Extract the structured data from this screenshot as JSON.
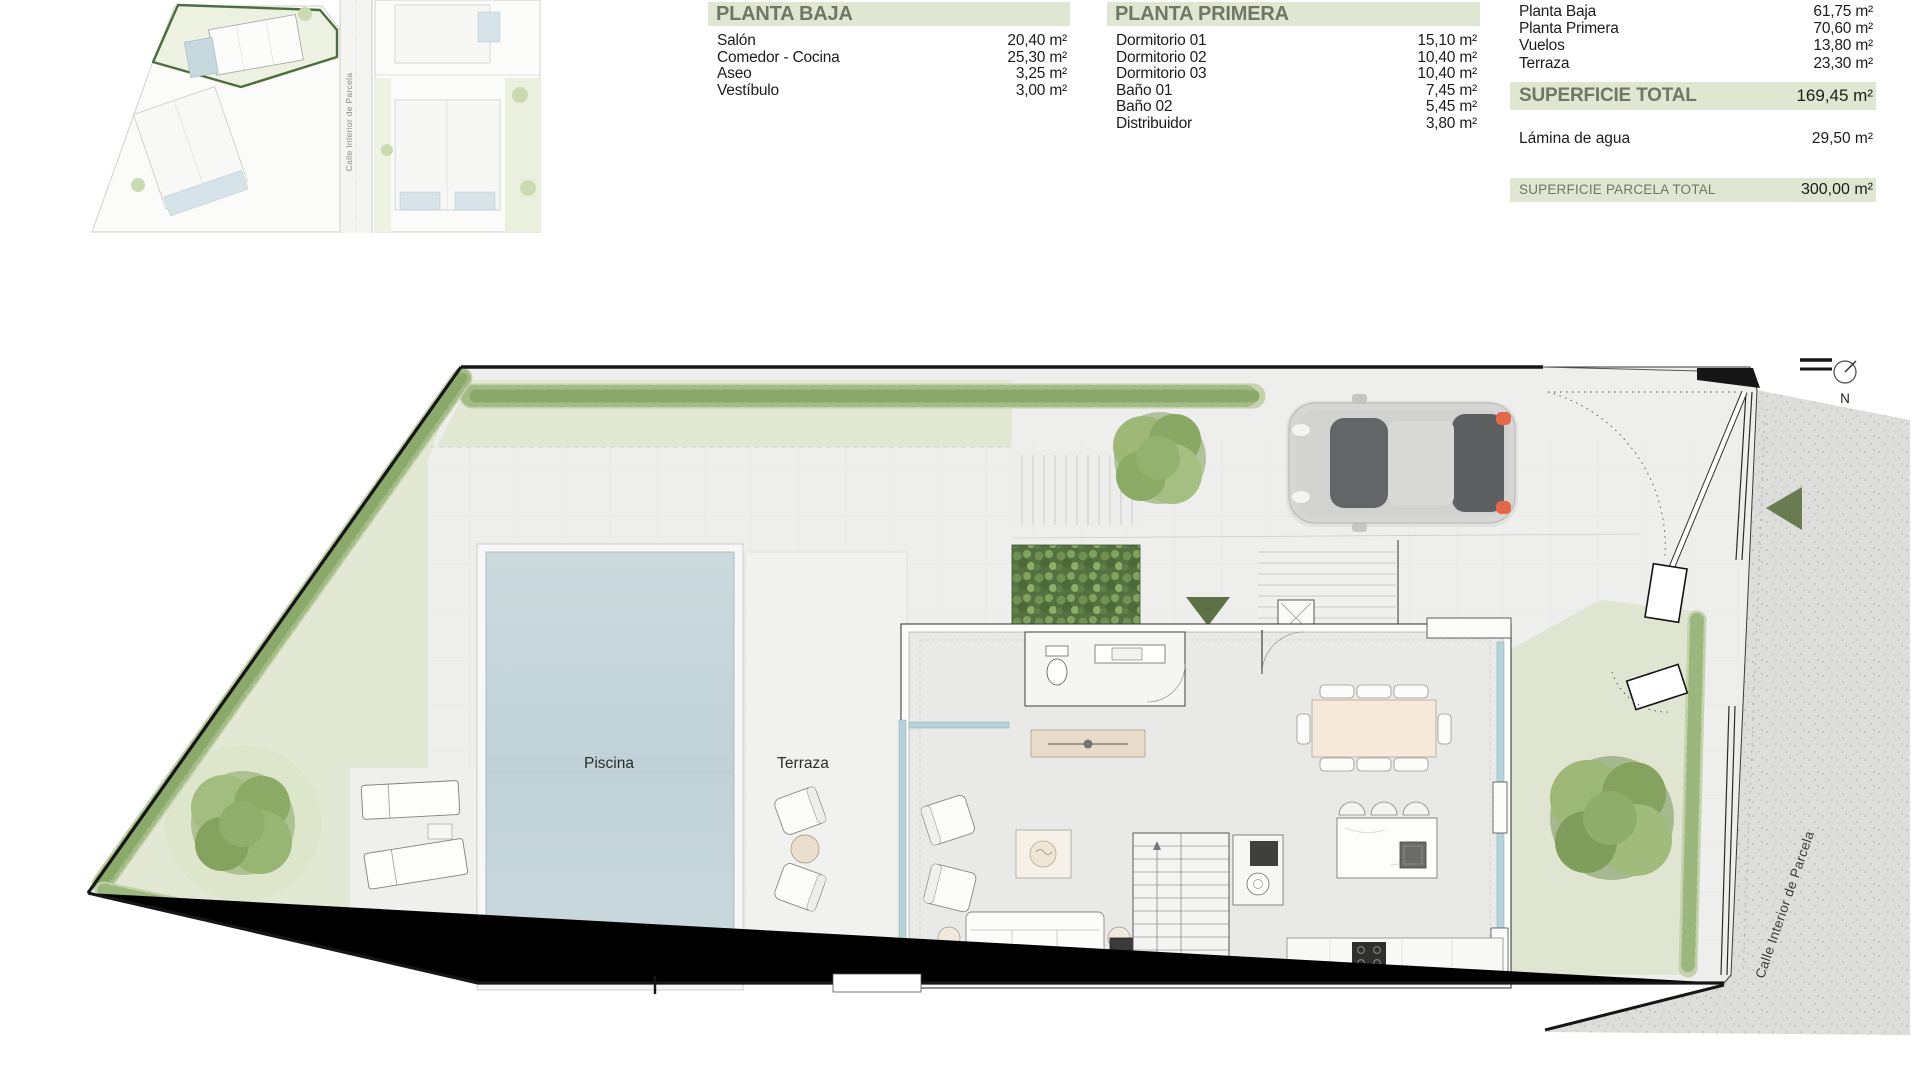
{
  "colors": {
    "band_green": "#dfe6d1",
    "band_text": "#6f7765",
    "highlight_green": "#4c6e3d",
    "lawn_green": "#e3e8d4",
    "pool_blue": "#c6d6db",
    "arrow_olive": "#6a7b51"
  },
  "area_tables": {
    "planta_baja": {
      "title": "PLANTA BAJA",
      "rows": [
        {
          "label": "Salón",
          "value": "20,40 m²"
        },
        {
          "label": "Comedor - Cocina",
          "value": "25,30 m²"
        },
        {
          "label": "Aseo",
          "value": "3,25 m²"
        },
        {
          "label": "Vestíbulo",
          "value": "3,00 m²"
        }
      ]
    },
    "planta_primera": {
      "title": "PLANTA PRIMERA",
      "rows": [
        {
          "label": "Dormitorio 01",
          "value": "15,10 m²"
        },
        {
          "label": "Dormitorio 02",
          "value": "10,40 m²"
        },
        {
          "label": "Dormitorio 03",
          "value": "10,40 m²"
        },
        {
          "label": "Baño 01",
          "value": "7,45 m²"
        },
        {
          "label": "Baño 02",
          "value": "5,45 m²"
        },
        {
          "label": "Distribuidor",
          "value": "3,80 m²"
        }
      ]
    },
    "summary": {
      "rows": [
        {
          "label": "Planta Baja",
          "value": "61,75 m²"
        },
        {
          "label": "Planta Primera",
          "value": "70,60 m²"
        },
        {
          "label": "Vuelos",
          "value": "13,80 m²"
        },
        {
          "label": "Terraza",
          "value": "23,30 m²"
        }
      ],
      "total_label": "SUPERFICIE TOTAL",
      "total_value": "169,45 m²",
      "water_label": "Lámina de agua",
      "water_value": "29,50 m²",
      "parcel_label": "SUPERFICIE PARCELA TOTAL",
      "parcel_value": "300,00 m²"
    }
  },
  "plan": {
    "labels": {
      "pool": "Piscina",
      "terrace": "Terraza",
      "street": "Calle Interior de Parcela",
      "north": "N"
    }
  },
  "vignette": {
    "street_label": "Calle Interior de Parcela"
  }
}
